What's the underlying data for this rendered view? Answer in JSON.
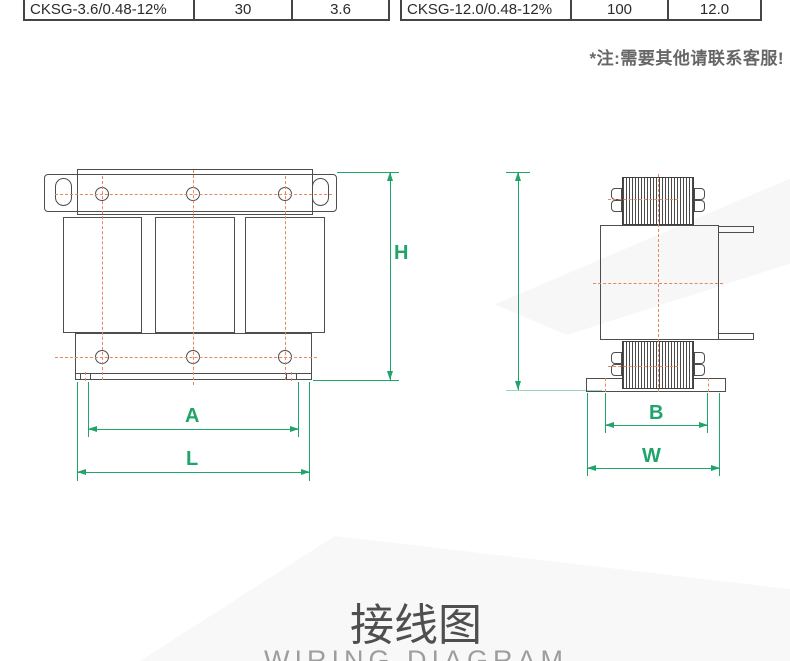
{
  "spec_table_left": {
    "model": "CKSG-3.6/0.48-12%",
    "rated_capacity": "30",
    "inductance": "3.6"
  },
  "spec_table_right": {
    "model": "CKSG-12.0/0.48-12%",
    "rated_capacity": "100",
    "inductance": "12.0"
  },
  "note": "*注:需要其他请联系客服!",
  "dimensions": {
    "height": "H",
    "mounting_width": "A",
    "overall_length": "L",
    "mounting_depth": "B",
    "overall_width": "W"
  },
  "section_title": {
    "zh": "接线图",
    "en": "WIRING DIAGRAM"
  },
  "colors": {
    "dimension_green": "#1fa46a",
    "centerline_orange": "#e8875f",
    "outline_gray": "#4d4d4d",
    "note_gray": "#666666"
  }
}
